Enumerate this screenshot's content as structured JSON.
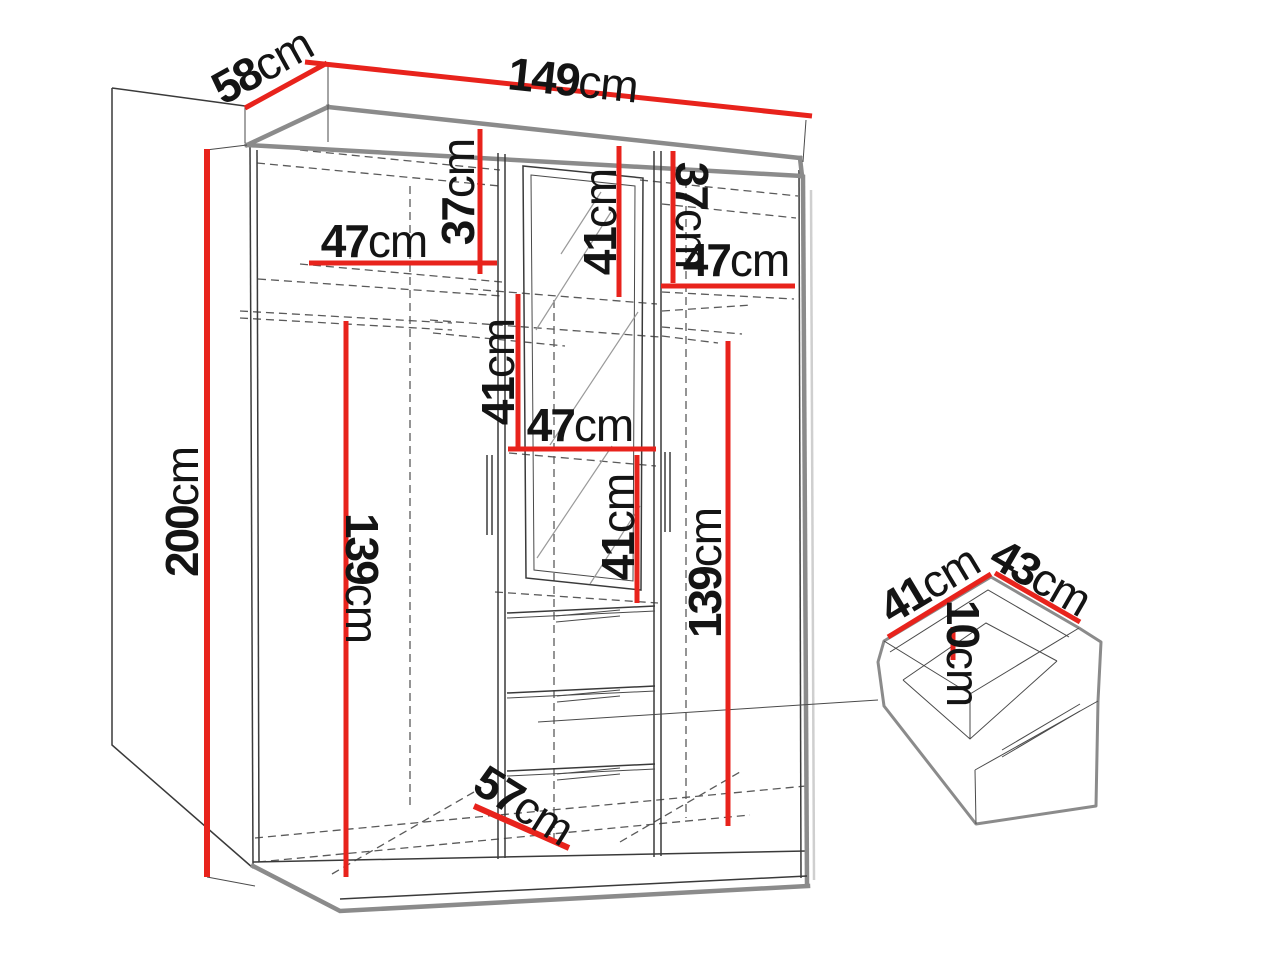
{
  "unit_default": "cm",
  "colors": {
    "dimension_red": "#e8231c",
    "line_dark": "#3a3a3a",
    "edge_gray": "#8b8b8b",
    "background": "#ffffff",
    "text": "#141414"
  },
  "dimensions": {
    "top_width": {
      "value": "149",
      "unit": "cm"
    },
    "top_depth": {
      "value": "58",
      "unit": "cm"
    },
    "height": {
      "value": "200",
      "unit": "cm"
    },
    "left_top_section": {
      "value": "37",
      "unit": "cm"
    },
    "left_shelf_width": {
      "value": "47",
      "unit": "cm"
    },
    "center_top_section": {
      "value": "41",
      "unit": "cm"
    },
    "right_top_section": {
      "value": "37",
      "unit": "cm"
    },
    "right_shelf_width": {
      "value": "47",
      "unit": "cm"
    },
    "center_mid_section": {
      "value": "41",
      "unit": "cm"
    },
    "center_shelf_width": {
      "value": "47",
      "unit": "cm"
    },
    "center_lower_section": {
      "value": "41",
      "unit": "cm"
    },
    "left_hanging_space": {
      "value": "139",
      "unit": "cm"
    },
    "right_hanging_space": {
      "value": "139",
      "unit": "cm"
    },
    "floor_depth": {
      "value": "57",
      "unit": "cm"
    },
    "drawer_depth": {
      "value": "41",
      "unit": "cm"
    },
    "drawer_width": {
      "value": "43",
      "unit": "cm"
    },
    "drawer_height": {
      "value": "10",
      "unit": "cm"
    }
  }
}
